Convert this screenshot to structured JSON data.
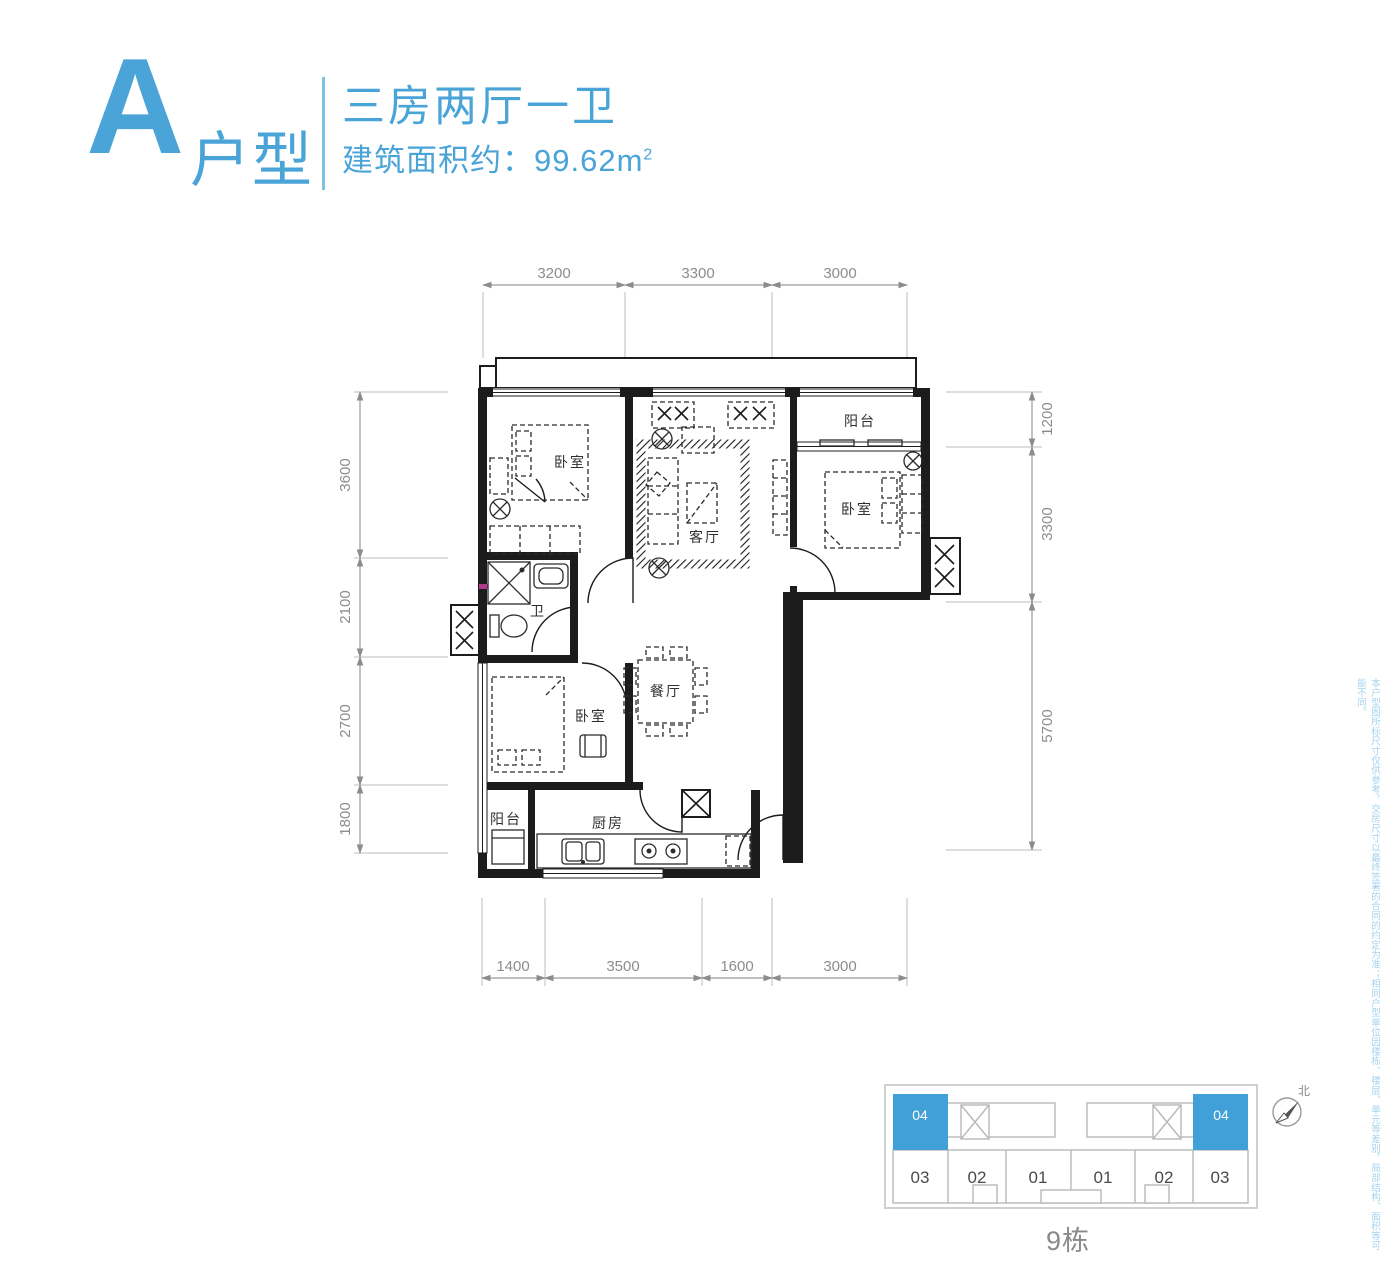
{
  "header": {
    "type_letter": "A",
    "type_suffix": "户型",
    "layout_title": "三房两厅一卫",
    "area_text": "建筑面积约：99.62m",
    "area_exponent": "2"
  },
  "plan": {
    "rooms": {
      "bedroom_top_left": "卧室",
      "living_room": "客厅",
      "balcony_top": "阳台",
      "bedroom_right": "卧室",
      "bathroom": "卫",
      "dining_room": "餐厅",
      "bedroom_bottom": "卧室",
      "kitchen": "厨房",
      "balcony_bottom": "阳台"
    },
    "dimensions": {
      "top": [
        "3200",
        "3300",
        "3000"
      ],
      "bottom": [
        "1400",
        "3500",
        "1600",
        "3000"
      ],
      "left": [
        "3600",
        "2100",
        "2700",
        "1800"
      ],
      "right": [
        "1200",
        "3300",
        "5700"
      ]
    }
  },
  "disclaimer": "本户型图所标尺寸仅供参考，交房尺寸以最终签署的合同的约定为准；相同户型单位因楼栋、楼层、单元等差别，局部结构、面积等可能不同。",
  "keyplan": {
    "highlighted_units": [
      "04",
      "04"
    ],
    "units": [
      "03",
      "02",
      "01",
      "01",
      "02",
      "03"
    ],
    "building_label": "9栋",
    "north_label": "北"
  },
  "colors": {
    "accent_blue": "#4aa4d8",
    "keyplan_blue": "#41a0d8",
    "disclaimer_blue": "#a5d3ee",
    "dimension_gray": "#8c8c8c",
    "plan_black": "#1c1c1c"
  }
}
